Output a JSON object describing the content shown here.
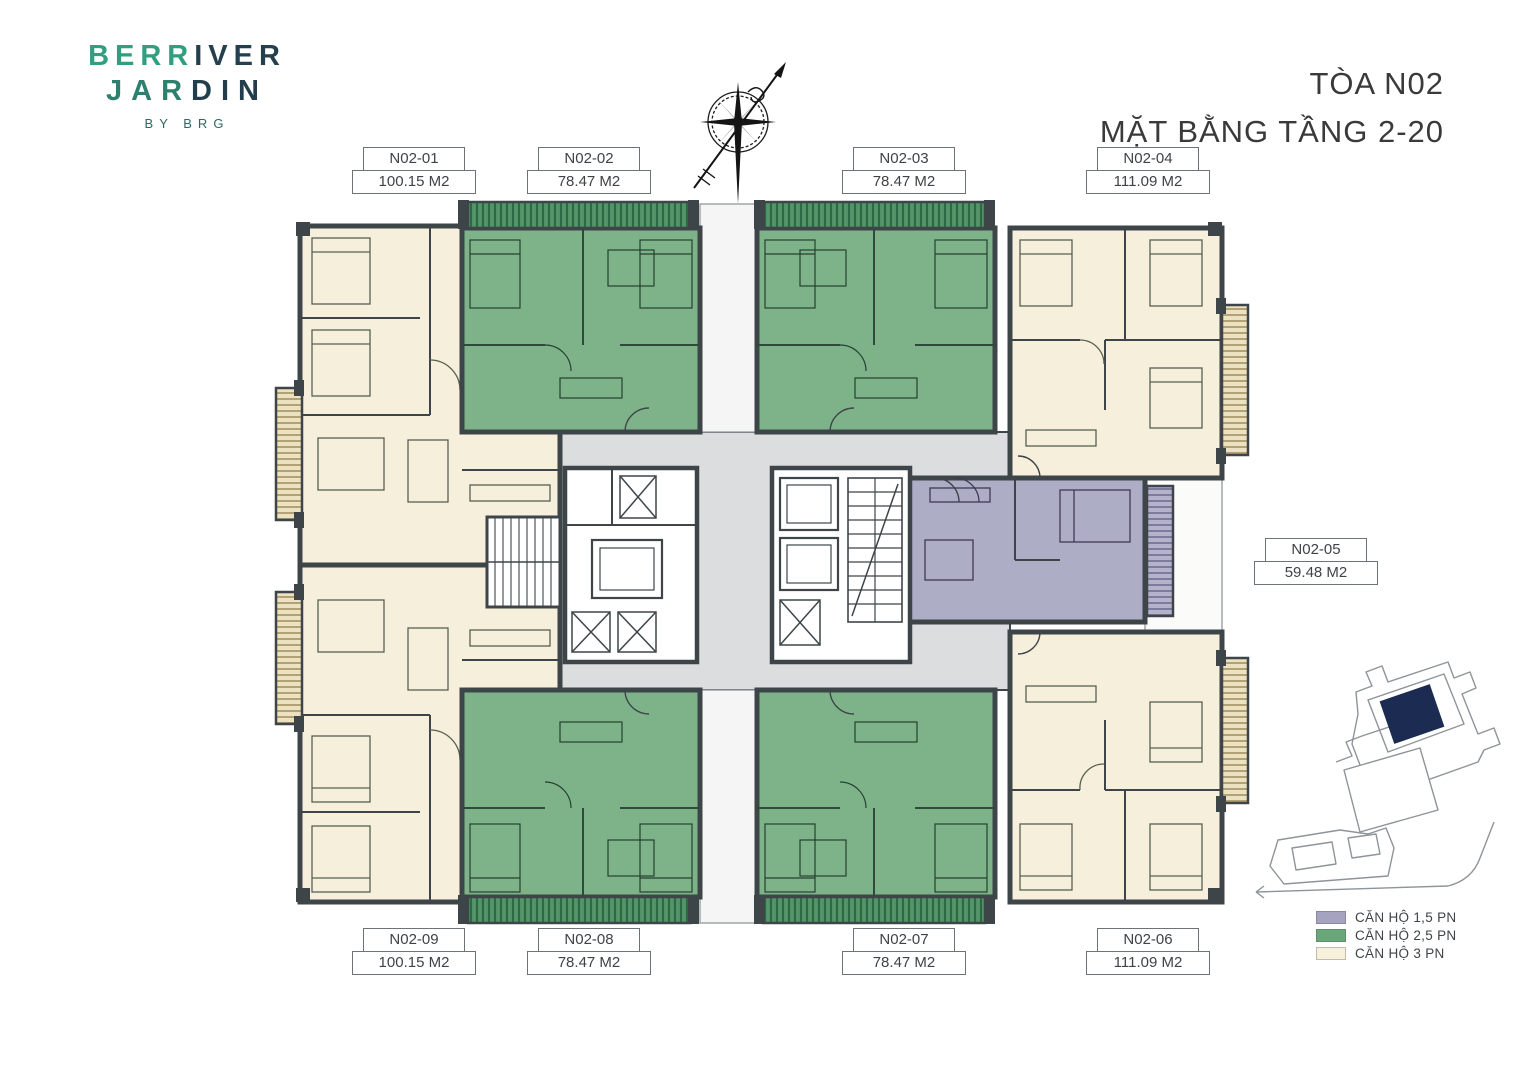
{
  "brand": {
    "part1": "BERR",
    "part2": "IVER",
    "part3": "JAR",
    "part4": "DIN",
    "byline": "BY BRG"
  },
  "title": {
    "line1": "TÒA N02",
    "line2": "MẶT BẰNG TẦNG 2-20"
  },
  "units": [
    {
      "id": "N02-01",
      "area": "100.15 M2",
      "type": "CĂN HỘ 3 PN"
    },
    {
      "id": "N02-02",
      "area": "78.47 M2",
      "type": "CĂN HỘ 2,5 PN"
    },
    {
      "id": "N02-03",
      "area": "78.47 M2",
      "type": "CĂN HỘ 2,5 PN"
    },
    {
      "id": "N02-04",
      "area": "111.09 M2",
      "type": "CĂN HỘ 3 PN"
    },
    {
      "id": "N02-05",
      "area": "59.48 M2",
      "type": "CĂN HỘ 1,5 PN"
    },
    {
      "id": "N02-06",
      "area": "111.09 M2",
      "type": "CĂN HỘ 3 PN"
    },
    {
      "id": "N02-07",
      "area": "78.47 M2",
      "type": "CĂN HỘ 2,5 PN"
    },
    {
      "id": "N02-08",
      "area": "78.47 M2",
      "type": "CĂN HỘ 2,5 PN"
    },
    {
      "id": "N02-09",
      "area": "100.15 M2",
      "type": "CĂN HỘ 3 PN"
    }
  ],
  "legend": [
    {
      "label": "CĂN HỘ 1,5 PN",
      "color": "#a5a3c0"
    },
    {
      "label": "CĂN HỘ 2,5 PN",
      "color": "#68a878"
    },
    {
      "label": "CĂN HỘ 3 PN",
      "color": "#f7f0da"
    }
  ],
  "colors": {
    "wall": "#3e4549",
    "apartment_3pn": "#f6efdb",
    "apartment_25pn": "#7eb38a",
    "apartment_15pn": "#aeadc6",
    "corridor": "#dcddde",
    "site_highlight": "#1c2b52"
  },
  "icons": {
    "compass": "compass-rose-north-arrow",
    "sitemap": "site-location-minimap"
  }
}
